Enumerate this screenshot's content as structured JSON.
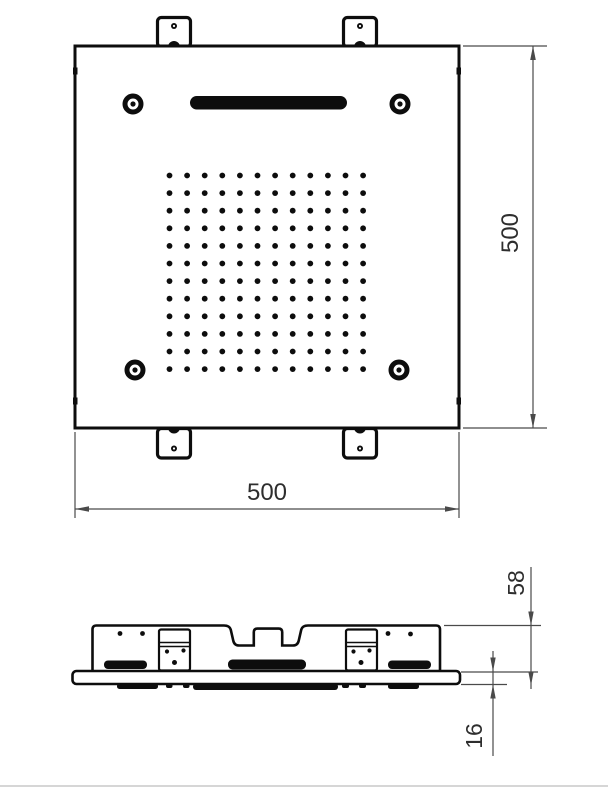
{
  "colors": {
    "ink": "#0d0d0d",
    "dim_line": "#4a4a4a",
    "dim_text": "#2e2e2e",
    "separator": "#c9c9c9",
    "bg": "#ffffff"
  },
  "top_view": {
    "width_label": "500",
    "height_label": "500",
    "nozzle_grid": {
      "rows": 12,
      "cols": 12,
      "x0": 169.5,
      "y0": 175.5,
      "dx": 17.6,
      "dy": 17.6,
      "r": 2.9
    },
    "screws": [
      {
        "cx": 133,
        "cy": 104
      },
      {
        "cx": 400,
        "cy": 104
      },
      {
        "cx": 135,
        "cy": 370
      },
      {
        "cx": 399,
        "cy": 370
      }
    ],
    "brackets": [
      {
        "cx": 174,
        "edge": "top"
      },
      {
        "cx": 360,
        "edge": "top"
      },
      {
        "cx": 174,
        "edge": "bottom"
      },
      {
        "cx": 360,
        "edge": "bottom"
      }
    ],
    "edge_clips": [
      {
        "x": 73,
        "y": 67.5
      },
      {
        "x": 456.5,
        "y": 67.5
      },
      {
        "x": 73,
        "y": 397.5
      },
      {
        "x": 456.5,
        "y": 397.5
      }
    ]
  },
  "side_view": {
    "height_label": "58",
    "plate_label": "16"
  }
}
